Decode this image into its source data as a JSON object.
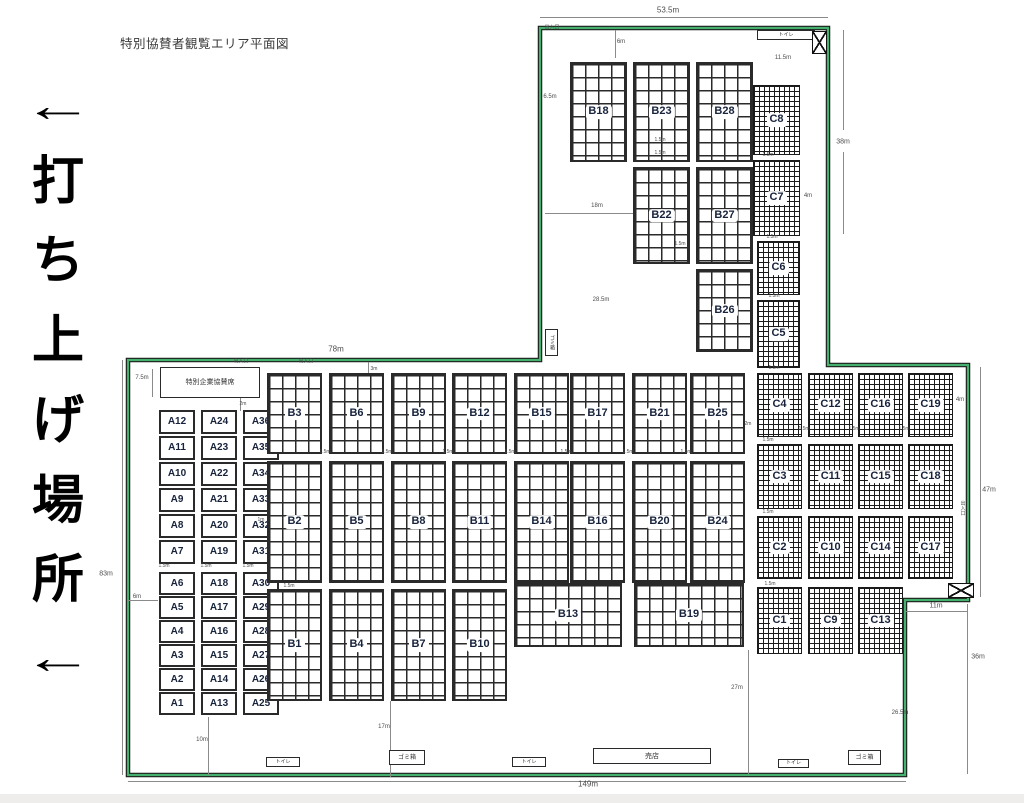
{
  "title": "特別協賛者観覧エリア平面図",
  "side_text": [
    "←",
    "打",
    "ち",
    "上",
    "げ",
    "場",
    "所",
    "←"
  ],
  "colors": {
    "boundary_green": "#46b06e",
    "outline_black": "#1c1c1c",
    "block_label": "#17223b",
    "dim_text": "#4d4d4d"
  },
  "blocks": [
    {
      "label": "A12",
      "x": 159,
      "y": 410,
      "w": 36,
      "h": 24,
      "g": "plain"
    },
    {
      "label": "A11",
      "x": 159,
      "y": 436,
      "w": 36,
      "h": 24,
      "g": "plain"
    },
    {
      "label": "A10",
      "x": 159,
      "y": 462,
      "w": 36,
      "h": 24,
      "g": "plain"
    },
    {
      "label": "A9",
      "x": 159,
      "y": 488,
      "w": 36,
      "h": 24,
      "g": "plain"
    },
    {
      "label": "A8",
      "x": 159,
      "y": 514,
      "w": 36,
      "h": 24,
      "g": "plain"
    },
    {
      "label": "A7",
      "x": 159,
      "y": 540,
      "w": 36,
      "h": 24,
      "g": "plain"
    },
    {
      "label": "A6",
      "x": 159,
      "y": 572,
      "w": 36,
      "h": 23,
      "g": "plain"
    },
    {
      "label": "A5",
      "x": 159,
      "y": 596,
      "w": 36,
      "h": 23,
      "g": "plain"
    },
    {
      "label": "A4",
      "x": 159,
      "y": 620,
      "w": 36,
      "h": 23,
      "g": "plain"
    },
    {
      "label": "A3",
      "x": 159,
      "y": 644,
      "w": 36,
      "h": 23,
      "g": "plain"
    },
    {
      "label": "A2",
      "x": 159,
      "y": 668,
      "w": 36,
      "h": 23,
      "g": "plain"
    },
    {
      "label": "A1",
      "x": 159,
      "y": 692,
      "w": 36,
      "h": 23,
      "g": "plain"
    },
    {
      "label": "A24",
      "x": 201,
      "y": 410,
      "w": 36,
      "h": 24,
      "g": "plain"
    },
    {
      "label": "A23",
      "x": 201,
      "y": 436,
      "w": 36,
      "h": 24,
      "g": "plain"
    },
    {
      "label": "A22",
      "x": 201,
      "y": 462,
      "w": 36,
      "h": 24,
      "g": "plain"
    },
    {
      "label": "A21",
      "x": 201,
      "y": 488,
      "w": 36,
      "h": 24,
      "g": "plain"
    },
    {
      "label": "A20",
      "x": 201,
      "y": 514,
      "w": 36,
      "h": 24,
      "g": "plain"
    },
    {
      "label": "A19",
      "x": 201,
      "y": 540,
      "w": 36,
      "h": 24,
      "g": "plain"
    },
    {
      "label": "A18",
      "x": 201,
      "y": 572,
      "w": 36,
      "h": 23,
      "g": "plain"
    },
    {
      "label": "A17",
      "x": 201,
      "y": 596,
      "w": 36,
      "h": 23,
      "g": "plain"
    },
    {
      "label": "A16",
      "x": 201,
      "y": 620,
      "w": 36,
      "h": 23,
      "g": "plain"
    },
    {
      "label": "A15",
      "x": 201,
      "y": 644,
      "w": 36,
      "h": 23,
      "g": "plain"
    },
    {
      "label": "A14",
      "x": 201,
      "y": 668,
      "w": 36,
      "h": 23,
      "g": "plain"
    },
    {
      "label": "A13",
      "x": 201,
      "y": 692,
      "w": 36,
      "h": 23,
      "g": "plain"
    },
    {
      "label": "A36",
      "x": 243,
      "y": 410,
      "w": 36,
      "h": 24,
      "g": "plain"
    },
    {
      "label": "A35",
      "x": 243,
      "y": 436,
      "w": 36,
      "h": 24,
      "g": "plain"
    },
    {
      "label": "A34",
      "x": 243,
      "y": 462,
      "w": 36,
      "h": 24,
      "g": "plain"
    },
    {
      "label": "A33",
      "x": 243,
      "y": 488,
      "w": 36,
      "h": 24,
      "g": "plain"
    },
    {
      "label": "A32",
      "x": 243,
      "y": 514,
      "w": 36,
      "h": 24,
      "g": "plain"
    },
    {
      "label": "A31",
      "x": 243,
      "y": 540,
      "w": 36,
      "h": 24,
      "g": "plain"
    },
    {
      "label": "A30",
      "x": 243,
      "y": 572,
      "w": 36,
      "h": 23,
      "g": "plain"
    },
    {
      "label": "A29",
      "x": 243,
      "y": 596,
      "w": 36,
      "h": 23,
      "g": "plain"
    },
    {
      "label": "A28",
      "x": 243,
      "y": 620,
      "w": 36,
      "h": 23,
      "g": "plain"
    },
    {
      "label": "A27",
      "x": 243,
      "y": 644,
      "w": 36,
      "h": 23,
      "g": "plain"
    },
    {
      "label": "A26",
      "x": 243,
      "y": 668,
      "w": 36,
      "h": 23,
      "g": "plain"
    },
    {
      "label": "A25",
      "x": 243,
      "y": 692,
      "w": 36,
      "h": 23,
      "g": "plain"
    },
    {
      "label": "B18",
      "x": 570,
      "y": 62,
      "w": 57,
      "h": 100,
      "g": "coarse"
    },
    {
      "label": "B23",
      "x": 633,
      "y": 62,
      "w": 57,
      "h": 100,
      "g": "coarse"
    },
    {
      "label": "B28",
      "x": 696,
      "y": 62,
      "w": 57,
      "h": 100,
      "g": "coarse"
    },
    {
      "label": "B22",
      "x": 633,
      "y": 167,
      "w": 57,
      "h": 97,
      "g": "coarse"
    },
    {
      "label": "B27",
      "x": 696,
      "y": 167,
      "w": 57,
      "h": 97,
      "g": "coarse"
    },
    {
      "label": "B26",
      "x": 696,
      "y": 269,
      "w": 57,
      "h": 83,
      "g": "coarse"
    },
    {
      "label": "C8",
      "x": 753,
      "y": 85,
      "w": 47,
      "h": 70,
      "g": "fine"
    },
    {
      "label": "C7",
      "x": 753,
      "y": 160,
      "w": 47,
      "h": 76,
      "g": "fine"
    },
    {
      "label": "C6",
      "x": 757,
      "y": 241,
      "w": 43,
      "h": 54,
      "g": "fine"
    },
    {
      "label": "C5",
      "x": 757,
      "y": 300,
      "w": 43,
      "h": 68,
      "g": "fine"
    },
    {
      "label": "B3",
      "x": 267,
      "y": 373,
      "w": 55,
      "h": 81,
      "g": "coarse"
    },
    {
      "label": "B6",
      "x": 329,
      "y": 373,
      "w": 55,
      "h": 81,
      "g": "coarse"
    },
    {
      "label": "B9",
      "x": 391,
      "y": 373,
      "w": 55,
      "h": 81,
      "g": "coarse"
    },
    {
      "label": "B12",
      "x": 452,
      "y": 373,
      "w": 55,
      "h": 81,
      "g": "coarse"
    },
    {
      "label": "B15",
      "x": 514,
      "y": 373,
      "w": 55,
      "h": 81,
      "g": "coarse"
    },
    {
      "label": "B17",
      "x": 570,
      "y": 373,
      "w": 55,
      "h": 81,
      "g": "coarse"
    },
    {
      "label": "B21",
      "x": 632,
      "y": 373,
      "w": 55,
      "h": 81,
      "g": "coarse"
    },
    {
      "label": "B25",
      "x": 690,
      "y": 373,
      "w": 55,
      "h": 81,
      "g": "coarse"
    },
    {
      "label": "B2",
      "x": 267,
      "y": 461,
      "w": 55,
      "h": 122,
      "g": "coarse"
    },
    {
      "label": "B5",
      "x": 329,
      "y": 461,
      "w": 55,
      "h": 122,
      "g": "coarse"
    },
    {
      "label": "B8",
      "x": 391,
      "y": 461,
      "w": 55,
      "h": 122,
      "g": "coarse"
    },
    {
      "label": "B11",
      "x": 452,
      "y": 461,
      "w": 55,
      "h": 122,
      "g": "coarse"
    },
    {
      "label": "B14",
      "x": 514,
      "y": 461,
      "w": 55,
      "h": 122,
      "g": "coarse"
    },
    {
      "label": "B16",
      "x": 570,
      "y": 461,
      "w": 55,
      "h": 122,
      "g": "coarse"
    },
    {
      "label": "B20",
      "x": 632,
      "y": 461,
      "w": 55,
      "h": 122,
      "g": "coarse"
    },
    {
      "label": "B24",
      "x": 690,
      "y": 461,
      "w": 55,
      "h": 122,
      "g": "coarse"
    },
    {
      "label": "B1",
      "x": 267,
      "y": 589,
      "w": 55,
      "h": 112,
      "g": "coarse"
    },
    {
      "label": "B4",
      "x": 329,
      "y": 589,
      "w": 55,
      "h": 112,
      "g": "coarse"
    },
    {
      "label": "B7",
      "x": 391,
      "y": 589,
      "w": 55,
      "h": 112,
      "g": "coarse"
    },
    {
      "label": "B10",
      "x": 452,
      "y": 589,
      "w": 55,
      "h": 112,
      "g": "coarse"
    },
    {
      "label": "B13",
      "x": 514,
      "y": 583,
      "w": 108,
      "h": 64,
      "g": "coarse"
    },
    {
      "label": "B19",
      "x": 634,
      "y": 583,
      "w": 110,
      "h": 64,
      "g": "coarse"
    },
    {
      "label": "C4",
      "x": 757,
      "y": 373,
      "w": 45,
      "h": 64,
      "g": "fine"
    },
    {
      "label": "C12",
      "x": 808,
      "y": 373,
      "w": 45,
      "h": 64,
      "g": "fine"
    },
    {
      "label": "C16",
      "x": 858,
      "y": 373,
      "w": 45,
      "h": 64,
      "g": "fine"
    },
    {
      "label": "C19",
      "x": 908,
      "y": 373,
      "w": 45,
      "h": 64,
      "g": "fine"
    },
    {
      "label": "C3",
      "x": 757,
      "y": 444,
      "w": 45,
      "h": 65,
      "g": "fine"
    },
    {
      "label": "C11",
      "x": 808,
      "y": 444,
      "w": 45,
      "h": 65,
      "g": "fine"
    },
    {
      "label": "C15",
      "x": 858,
      "y": 444,
      "w": 45,
      "h": 65,
      "g": "fine"
    },
    {
      "label": "C18",
      "x": 908,
      "y": 444,
      "w": 45,
      "h": 65,
      "g": "fine"
    },
    {
      "label": "C2",
      "x": 757,
      "y": 516,
      "w": 45,
      "h": 63,
      "g": "fine"
    },
    {
      "label": "C10",
      "x": 808,
      "y": 516,
      "w": 45,
      "h": 63,
      "g": "fine"
    },
    {
      "label": "C14",
      "x": 858,
      "y": 516,
      "w": 45,
      "h": 63,
      "g": "fine"
    },
    {
      "label": "C17",
      "x": 908,
      "y": 516,
      "w": 45,
      "h": 63,
      "g": "fine"
    },
    {
      "label": "C1",
      "x": 757,
      "y": 587,
      "w": 45,
      "h": 67,
      "g": "fine"
    },
    {
      "label": "C9",
      "x": 808,
      "y": 587,
      "w": 45,
      "h": 67,
      "g": "fine"
    },
    {
      "label": "C13",
      "x": 858,
      "y": 587,
      "w": 45,
      "h": 67,
      "g": "fine"
    }
  ],
  "facilities": [
    {
      "name": "corporate-sponsor-seats",
      "label": "特別企業協賛席",
      "x": 160,
      "y": 367,
      "w": 100,
      "h": 31,
      "fs": 7
    },
    {
      "name": "trash-box",
      "label": "ゴミ箱",
      "x": 545,
      "y": 329,
      "w": 13,
      "h": 27,
      "fs": 5,
      "vert": true
    },
    {
      "name": "toilet",
      "label": "トイレ",
      "x": 757,
      "y": 30,
      "w": 58,
      "h": 10,
      "fs": 5
    },
    {
      "name": "toilet",
      "label": "トイレ",
      "x": 266,
      "y": 757,
      "w": 34,
      "h": 10,
      "fs": 5
    },
    {
      "name": "trash-box",
      "label": "ゴミ箱",
      "x": 389,
      "y": 750,
      "w": 36,
      "h": 15,
      "fs": 6
    },
    {
      "name": "toilet",
      "label": "トイレ",
      "x": 512,
      "y": 757,
      "w": 34,
      "h": 10,
      "fs": 5
    },
    {
      "name": "shop",
      "label": "売店",
      "x": 593,
      "y": 748,
      "w": 118,
      "h": 16,
      "fs": 7
    },
    {
      "name": "toilet",
      "label": "トイレ",
      "x": 778,
      "y": 759,
      "w": 31,
      "h": 9,
      "fs": 5
    },
    {
      "name": "trash-box",
      "label": "ゴミ箱",
      "x": 848,
      "y": 750,
      "w": 33,
      "h": 15,
      "fs": 6
    }
  ],
  "gates": [
    {
      "name": "gate-marker",
      "x": 812,
      "y": 31,
      "w": 15,
      "h": 23
    },
    {
      "name": "gate-marker",
      "x": 948,
      "y": 583,
      "w": 26,
      "h": 15
    }
  ],
  "dim_labels": [
    {
      "t": "53.5m",
      "x": 668,
      "y": 10,
      "fs": 8
    },
    {
      "t": "出入口",
      "x": 552,
      "y": 27,
      "fs": 5
    },
    {
      "t": "6m",
      "x": 621,
      "y": 42,
      "fs": 6
    },
    {
      "t": "11.5m",
      "x": 783,
      "y": 58,
      "fs": 6
    },
    {
      "t": "6.5m",
      "x": 550,
      "y": 97,
      "fs": 6
    },
    {
      "t": "38m",
      "x": 843,
      "y": 142,
      "fs": 7
    },
    {
      "t": "1.5m",
      "x": 660,
      "y": 140,
      "fs": 5
    },
    {
      "t": "1.5m",
      "x": 660,
      "y": 153,
      "fs": 5
    },
    {
      "t": "18m",
      "x": 597,
      "y": 206,
      "fs": 6
    },
    {
      "t": "4m",
      "x": 808,
      "y": 196,
      "fs": 6
    },
    {
      "t": "1.5m",
      "x": 768,
      "y": 155,
      "fs": 5
    },
    {
      "t": "1.5m",
      "x": 772,
      "y": 237,
      "fs": 5
    },
    {
      "t": "1.5m",
      "x": 774,
      "y": 296,
      "fs": 5
    },
    {
      "t": "1.5m",
      "x": 680,
      "y": 244,
      "fs": 5
    },
    {
      "t": "28.5m",
      "x": 601,
      "y": 300,
      "fs": 6
    },
    {
      "t": "1.5m",
      "x": 774,
      "y": 368,
      "fs": 5
    },
    {
      "t": "78m",
      "x": 336,
      "y": 349,
      "fs": 8
    },
    {
      "t": "出入口",
      "x": 306,
      "y": 361,
      "fs": 5
    },
    {
      "t": "3m",
      "x": 374,
      "y": 369,
      "fs": 5
    },
    {
      "t": "出入口",
      "x": 241,
      "y": 361,
      "fs": 5
    },
    {
      "t": "7.5m",
      "x": 142,
      "y": 378,
      "fs": 6
    },
    {
      "t": "2m",
      "x": 243,
      "y": 404,
      "fs": 5
    },
    {
      "t": "2m",
      "x": 748,
      "y": 424,
      "fs": 5
    },
    {
      "t": "1m",
      "x": 261,
      "y": 520,
      "fs": 5
    },
    {
      "t": "83m",
      "x": 106,
      "y": 574,
      "fs": 7
    },
    {
      "t": "6m",
      "x": 137,
      "y": 597,
      "fs": 6
    },
    {
      "t": "1.5m",
      "x": 164,
      "y": 566,
      "fs": 5
    },
    {
      "t": "1.5m",
      "x": 206,
      "y": 566,
      "fs": 5
    },
    {
      "t": "1.5m",
      "x": 248,
      "y": 566,
      "fs": 5
    },
    {
      "t": "1.5m",
      "x": 289,
      "y": 586,
      "fs": 5
    },
    {
      "t": "1.5m",
      "x": 325,
      "y": 452,
      "fs": 5
    },
    {
      "t": "1.5m",
      "x": 387,
      "y": 452,
      "fs": 5
    },
    {
      "t": "1.5m",
      "x": 448,
      "y": 452,
      "fs": 5
    },
    {
      "t": "1.5m",
      "x": 510,
      "y": 452,
      "fs": 5
    },
    {
      "t": "1.5m",
      "x": 566,
      "y": 452,
      "fs": 5
    },
    {
      "t": "1.5m",
      "x": 628,
      "y": 452,
      "fs": 5
    },
    {
      "t": "1.5m",
      "x": 686,
      "y": 452,
      "fs": 5
    },
    {
      "t": "1.5m",
      "x": 804,
      "y": 429,
      "fs": 5
    },
    {
      "t": "1.5m",
      "x": 854,
      "y": 429,
      "fs": 5
    },
    {
      "t": "1.5m",
      "x": 904,
      "y": 429,
      "fs": 5
    },
    {
      "t": "1.5m",
      "x": 768,
      "y": 440,
      "fs": 5
    },
    {
      "t": "1.5m",
      "x": 768,
      "y": 512,
      "fs": 5
    },
    {
      "t": "1.5m",
      "x": 770,
      "y": 584,
      "fs": 5
    },
    {
      "t": "4m",
      "x": 960,
      "y": 400,
      "fs": 6
    },
    {
      "t": "47m",
      "x": 989,
      "y": 490,
      "fs": 7
    },
    {
      "t": "出入口",
      "x": 963,
      "y": 508,
      "fs": 5,
      "vert": true
    },
    {
      "t": "11m",
      "x": 936,
      "y": 606,
      "fs": 7
    },
    {
      "t": "36m",
      "x": 978,
      "y": 657,
      "fs": 7
    },
    {
      "t": "27m",
      "x": 737,
      "y": 688,
      "fs": 6
    },
    {
      "t": "26.5m",
      "x": 900,
      "y": 713,
      "fs": 6
    },
    {
      "t": "17m",
      "x": 384,
      "y": 727,
      "fs": 6
    },
    {
      "t": "10m",
      "x": 202,
      "y": 740,
      "fs": 6
    },
    {
      "t": "149m",
      "x": 588,
      "y": 784,
      "fs": 8
    }
  ],
  "dim_lines": [
    {
      "x": 540,
      "y": 17,
      "w": 288,
      "h": 1
    },
    {
      "x": 122,
      "y": 360,
      "w": 1,
      "h": 415
    },
    {
      "x": 843,
      "y": 30,
      "w": 1,
      "h": 100
    },
    {
      "x": 843,
      "y": 152,
      "w": 1,
      "h": 82
    },
    {
      "x": 615,
      "y": 30,
      "w": 1,
      "h": 28
    },
    {
      "x": 545,
      "y": 213,
      "w": 88,
      "h": 1
    },
    {
      "x": 980,
      "y": 367,
      "w": 1,
      "h": 230
    },
    {
      "x": 905,
      "y": 611,
      "w": 63,
      "h": 1
    },
    {
      "x": 967,
      "y": 604,
      "w": 1,
      "h": 170
    },
    {
      "x": 152,
      "y": 369,
      "w": 1,
      "h": 28
    },
    {
      "x": 128,
      "y": 600,
      "w": 30,
      "h": 1
    },
    {
      "x": 390,
      "y": 701,
      "w": 1,
      "h": 76
    },
    {
      "x": 208,
      "y": 717,
      "w": 1,
      "h": 58
    },
    {
      "x": 748,
      "y": 650,
      "w": 1,
      "h": 124
    },
    {
      "x": 368,
      "y": 362,
      "w": 1,
      "h": 13
    },
    {
      "x": 240,
      "y": 398,
      "w": 1,
      "h": 13
    },
    {
      "x": 128,
      "y": 781,
      "w": 778,
      "h": 1
    }
  ]
}
